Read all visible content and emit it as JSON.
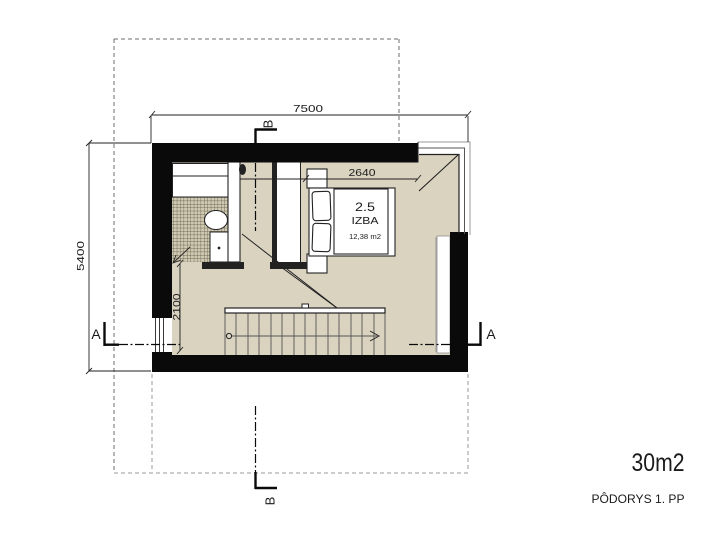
{
  "drawing": {
    "floor_label": {
      "area": "30m2",
      "title": "PÔDORYS 1. PP"
    },
    "room": {
      "number": "2.5",
      "name": "IZBA",
      "area": "12,38 m2"
    },
    "dimensions": {
      "overall_width": "7500",
      "overall_height": "5400",
      "bed_wall": "2640",
      "hall": "2100"
    },
    "sections": {
      "a": "A",
      "b": "B"
    }
  },
  "colors": {
    "background": "#ffffff",
    "wall": "#0a0a0a",
    "floor": "#d9d3c0",
    "tile_bg": "#d0c9b2",
    "tile_line": "#56503f",
    "line_dark": "#222222",
    "line_mid": "#555555",
    "line_gray": "#999999",
    "dash": "#6e6e6e",
    "white": "#ffffff",
    "text": "#1a1a1a"
  }
}
